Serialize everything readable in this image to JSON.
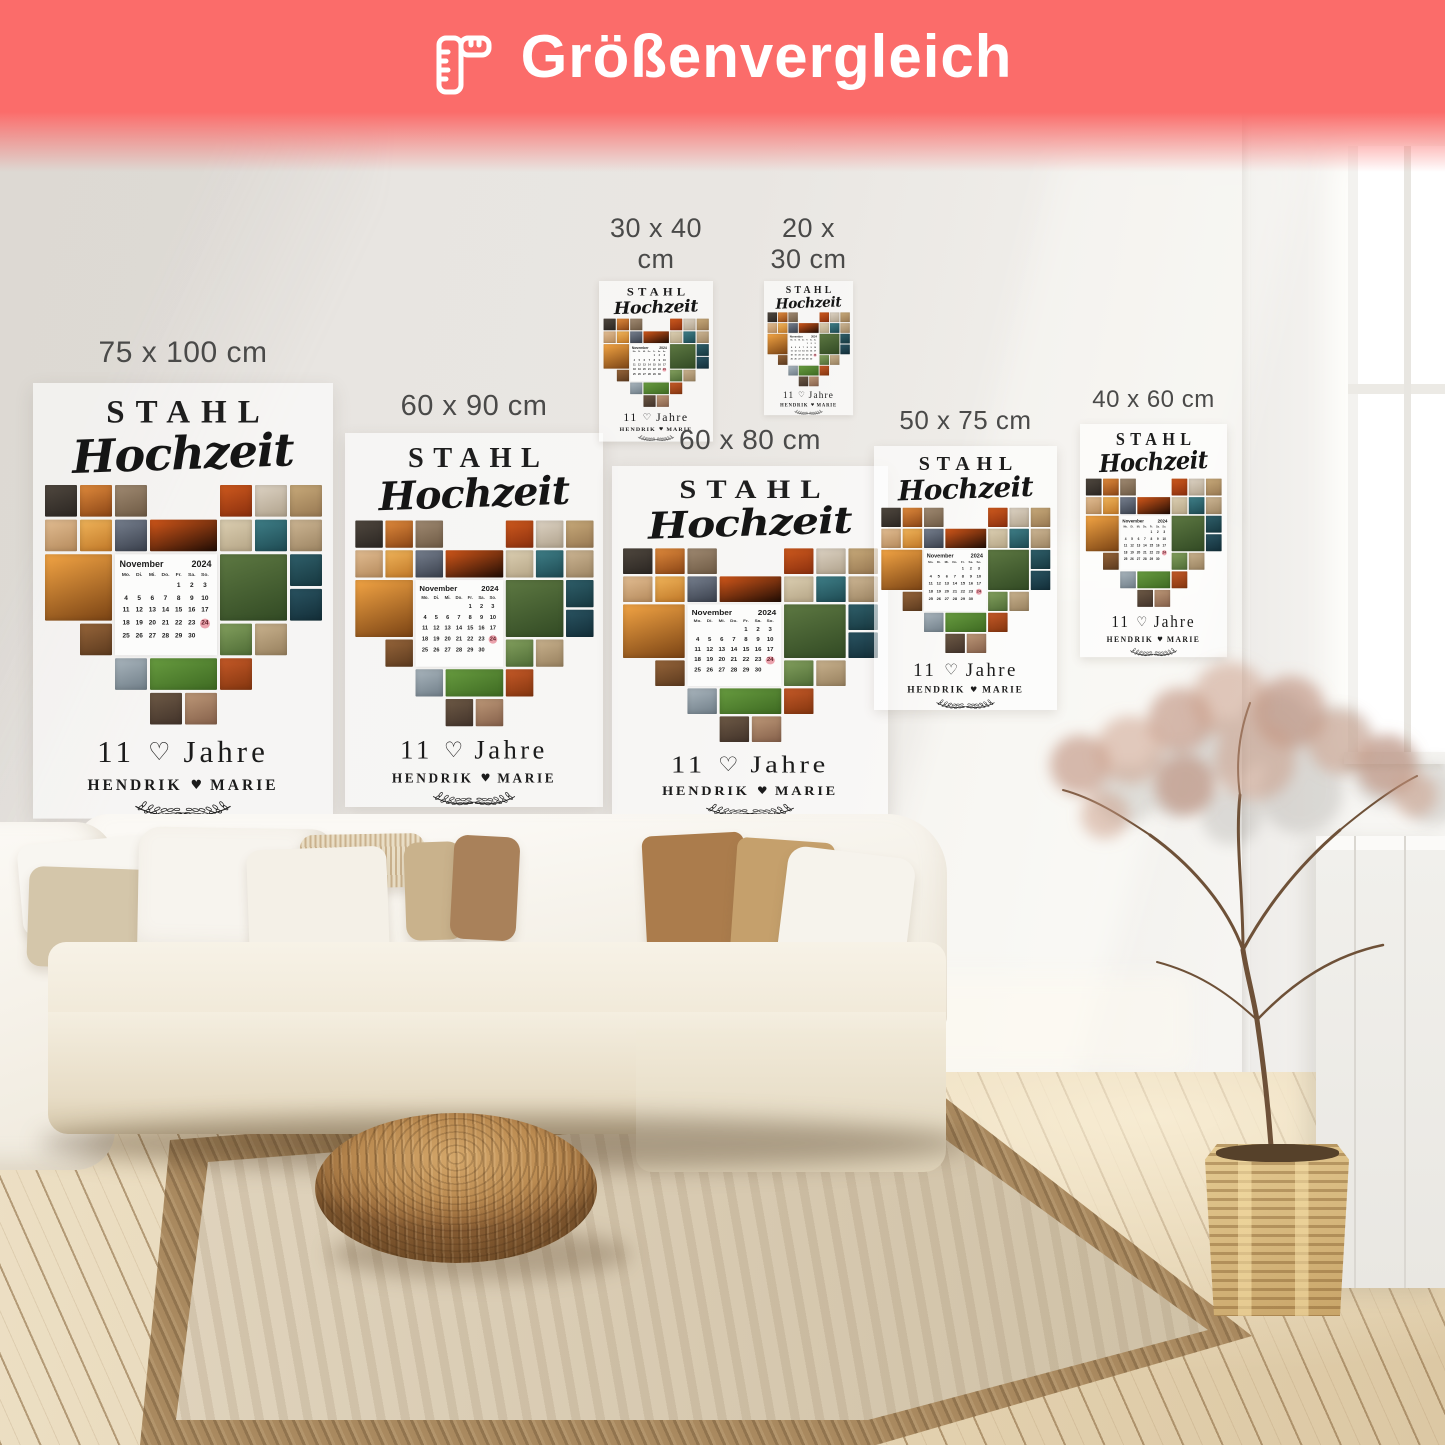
{
  "banner": {
    "title": "Größenvergleich",
    "background_color": "#fb6c6a",
    "text_color": "#ffffff",
    "icon": "ruler-icon"
  },
  "size_labels": [
    "75 x 100 cm",
    "60 x 90 cm",
    "30 x 40 cm",
    "20 x 30 cm",
    "60 x 80 cm",
    "50 x 75 cm",
    "40 x 60 cm"
  ],
  "label_color": "#4a4a49",
  "poster_design": {
    "title_line1": "STAHL",
    "title_line2": "Hochzeit",
    "years_number": "11",
    "heart_outline": "♡",
    "years_word": "Jahre",
    "name_left": "HENDRIK",
    "name_heart": "♥",
    "name_right": "MARIE",
    "calendar": {
      "month": "November",
      "year": "2024",
      "day_headers": [
        "Mo.",
        "Di.",
        "Mi.",
        "Do.",
        "Fr.",
        "Sa.",
        "So."
      ],
      "weeks": [
        [
          "",
          "",
          "",
          "",
          "1",
          "2",
          "3"
        ],
        [
          "4",
          "5",
          "6",
          "7",
          "8",
          "9",
          "10"
        ],
        [
          "11",
          "12",
          "13",
          "14",
          "15",
          "16",
          "17"
        ],
        [
          "18",
          "19",
          "20",
          "21",
          "22",
          "23",
          "24"
        ],
        [
          "25",
          "26",
          "27",
          "28",
          "29",
          "30",
          ""
        ]
      ],
      "highlighted_day": "24",
      "highlight_color": "#eba3ad"
    },
    "collage": {
      "grid_cols": 8,
      "grid_rows": 7,
      "tiles": [
        {
          "r": 1,
          "c": 1,
          "w": 1,
          "h": 1,
          "k": "mountain"
        },
        {
          "r": 1,
          "c": 2,
          "w": 1,
          "h": 1,
          "k": "sunset_person"
        },
        {
          "r": 1,
          "c": 3,
          "w": 1,
          "h": 1,
          "k": "rock_couple"
        },
        {
          "r": 1,
          "c": 6,
          "w": 1,
          "h": 1,
          "k": "orange_couple"
        },
        {
          "r": 1,
          "c": 7,
          "w": 1,
          "h": 1,
          "k": "bride"
        },
        {
          "r": 1,
          "c": 8,
          "w": 1,
          "h": 1,
          "k": "beach_dog"
        },
        {
          "r": 2,
          "c": 1,
          "w": 1,
          "h": 1,
          "k": "field_haze"
        },
        {
          "r": 2,
          "c": 2,
          "w": 1,
          "h": 1,
          "k": "sunset_glow"
        },
        {
          "r": 2,
          "c": 3,
          "w": 1,
          "h": 1,
          "k": "dusk_couple"
        },
        {
          "r": 2,
          "c": 4,
          "w": 2,
          "h": 1,
          "k": "dark_silhouette"
        },
        {
          "r": 2,
          "c": 6,
          "w": 1,
          "h": 1,
          "k": "dunes"
        },
        {
          "r": 2,
          "c": 7,
          "w": 1,
          "h": 1,
          "k": "teal_sea"
        },
        {
          "r": 2,
          "c": 8,
          "w": 1,
          "h": 1,
          "k": "beach_pair"
        },
        {
          "r": 3,
          "c": 1,
          "w": 2,
          "h": 2,
          "k": "sunset_chairs"
        },
        {
          "r": 3,
          "c": 6,
          "w": 2,
          "h": 2,
          "k": "wedding_arch"
        },
        {
          "r": 3,
          "c": 8,
          "w": 1,
          "h": 1,
          "k": "teal_dark"
        },
        {
          "r": 4,
          "c": 8,
          "w": 1,
          "h": 1,
          "k": "sea_dark"
        },
        {
          "r": 5,
          "c": 2,
          "w": 1,
          "h": 1,
          "k": "crowd_warm"
        },
        {
          "r": 5,
          "c": 6,
          "w": 1,
          "h": 1,
          "k": "garden_path"
        },
        {
          "r": 5,
          "c": 7,
          "w": 1,
          "h": 1,
          "k": "beach_couple"
        },
        {
          "r": 6,
          "c": 3,
          "w": 1,
          "h": 1,
          "k": "small_couple"
        },
        {
          "r": 6,
          "c": 4,
          "w": 2,
          "h": 1,
          "k": "green_picnic"
        },
        {
          "r": 6,
          "c": 6,
          "w": 1,
          "h": 1,
          "k": "red_picnic"
        },
        {
          "r": 7,
          "c": 4,
          "w": 1,
          "h": 1,
          "k": "bottom_dark"
        },
        {
          "r": 7,
          "c": 5,
          "w": 1,
          "h": 1,
          "k": "bottom_couple"
        }
      ],
      "palette": {
        "mountain": [
          "#50483f",
          "#2b2622"
        ],
        "sunset_person": [
          "#e08a3c",
          "#8a4516"
        ],
        "rock_couple": [
          "#a08a72",
          "#6e5a44"
        ],
        "orange_couple": [
          "#cf5a1e",
          "#8a2f0e"
        ],
        "bride": [
          "#ddd3c4",
          "#b0a28c"
        ],
        "beach_dog": [
          "#c8aa7a",
          "#977852"
        ],
        "field_haze": [
          "#e2bd92",
          "#b58a5c"
        ],
        "sunset_glow": [
          "#f0b45a",
          "#c07828"
        ],
        "dusk_couple": [
          "#77808f",
          "#3a404c"
        ],
        "dark_silhouette": [
          "#d4581a",
          "#200c04"
        ],
        "dunes": [
          "#dccfb2",
          "#b5a586"
        ],
        "teal_sea": [
          "#3f7f88",
          "#1e4a52"
        ],
        "beach_pair": [
          "#cdb694",
          "#9c8462"
        ],
        "sunset_chairs": [
          "#f2a444",
          "#7a4314"
        ],
        "wedding_arch": [
          "#5d7842",
          "#324a24"
        ],
        "teal_dark": [
          "#2f5f6a",
          "#173840"
        ],
        "sea_dark": [
          "#2a5462",
          "#132e38"
        ],
        "crowd_warm": [
          "#96653a",
          "#5c3a1e"
        ],
        "garden_path": [
          "#83a05e",
          "#4f6c36"
        ],
        "beach_couple": [
          "#c9b28e",
          "#97805e"
        ],
        "small_couple": [
          "#aab6be",
          "#707e88"
        ],
        "green_picnic": [
          "#689c40",
          "#3e6a22"
        ],
        "red_picnic": [
          "#c65a28",
          "#83350f"
        ],
        "bottom_dark": [
          "#6e5a46",
          "#42332a"
        ],
        "bottom_couple": [
          "#bd9878",
          "#85604a"
        ]
      }
    }
  }
}
